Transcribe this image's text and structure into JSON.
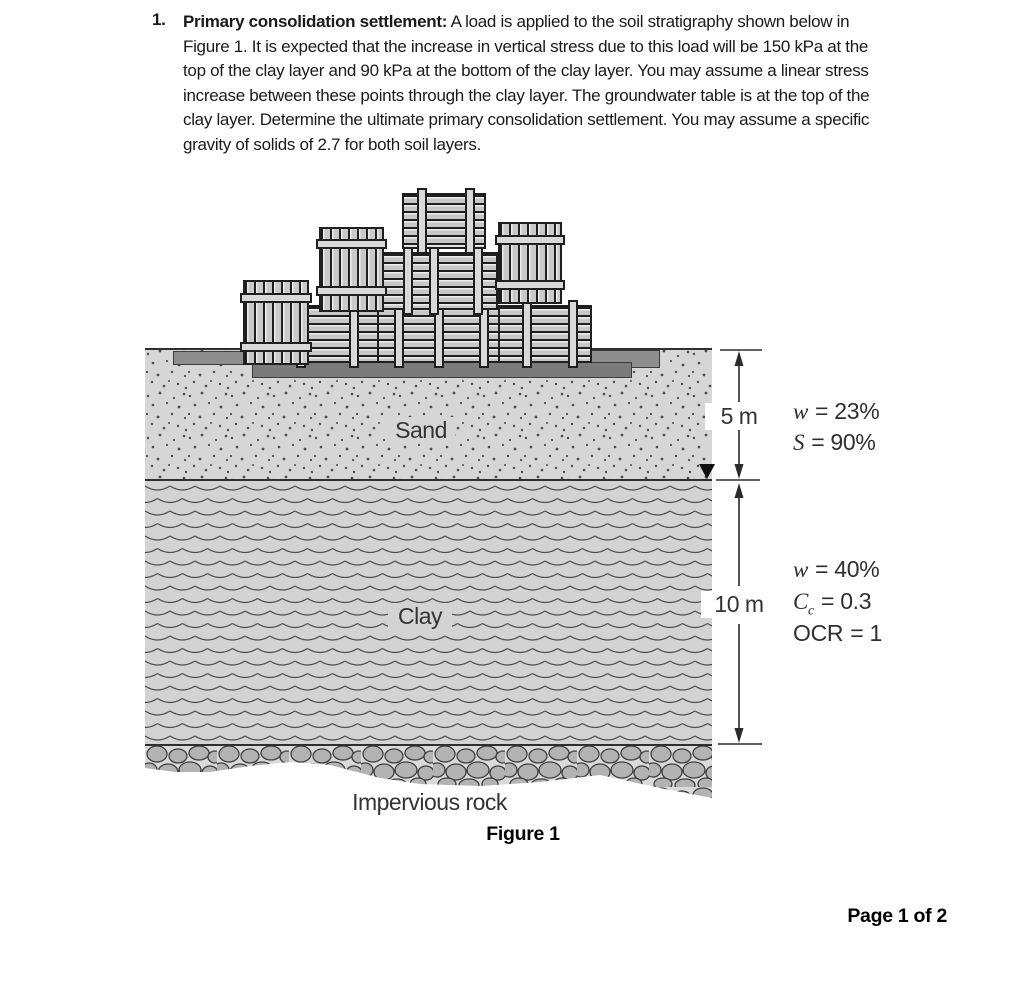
{
  "problem": {
    "number": "1.",
    "title": "Primary consolidation settlement:",
    "lines": [
      "A load is applied to the soil stratigraphy shown below in",
      "Figure 1. It is expected that the increase in vertical stress due to this load will be 150 kPa at the",
      "top of the clay layer and 90 kPa at the bottom of the clay layer. You may assume a linear stress",
      "increase between these points through the clay layer. The groundwater table is at the top of the",
      "clay layer. Determine the ultimate primary consolidation settlement. You may assume a specific",
      "gravity of solids of 2.7 for both soil layers."
    ]
  },
  "figure": {
    "caption": "Figure 1",
    "layers": {
      "sand": {
        "label": "Sand",
        "thickness": "5 m"
      },
      "clay": {
        "label": "Clay",
        "thickness": "10 m"
      },
      "rock": {
        "label": "Impervious rock"
      }
    },
    "sand_props": [
      {
        "sym": "w",
        "rest": "= 23%"
      },
      {
        "sym": "S",
        "rest": "= 90%"
      }
    ],
    "clay_props": [
      {
        "sym": "w",
        "rest": "= 40%"
      },
      {
        "sym": "C",
        "sub": "c",
        "rest": "= 0.3"
      },
      {
        "sym": "OCR",
        "rest": "= 1"
      }
    ],
    "groundwater_symbol": "water-table-triangle"
  },
  "colors": {
    "sand_fill": "#d5d6d5",
    "clay_fill": "#d2d3d2",
    "rock_matrix": "#dadada",
    "cobble": "#b3b3b3",
    "slab": "#8e8e8e",
    "line": "#2f2f2f"
  },
  "page": {
    "footer": "Page 1 of 2"
  }
}
